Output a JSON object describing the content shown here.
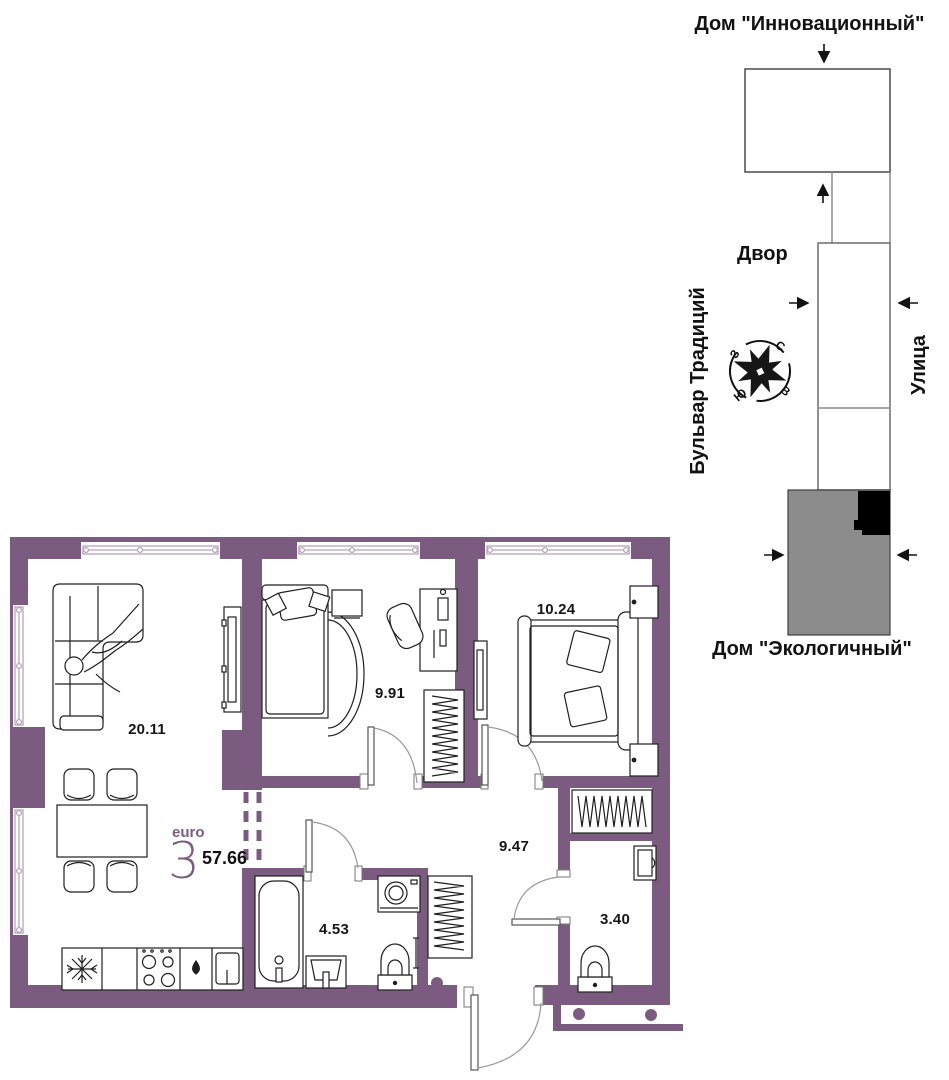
{
  "minimap": {
    "building_top_label": "Дом \"Инновационный\"",
    "building_bottom_label": "Дом \"Экологичный\"",
    "yard_label": "Двор",
    "boulevard_label": "Бульвар Традиций",
    "street_label": "Улица",
    "compass": {
      "north": "С",
      "east": "В",
      "south": "Ю",
      "west": "З"
    }
  },
  "plan": {
    "layout_label": "euro",
    "rooms_count": "3",
    "total_area": "57.66",
    "rooms": [
      {
        "name": "living-kitchen",
        "area": "20.11"
      },
      {
        "name": "bedroom-1",
        "area": "9.91"
      },
      {
        "name": "bedroom-2",
        "area": "10.24"
      },
      {
        "name": "hallway",
        "area": "9.47"
      },
      {
        "name": "bathroom",
        "area": "4.53"
      },
      {
        "name": "wc",
        "area": "3.40"
      }
    ]
  },
  "colors": {
    "wall": "#7B5C80",
    "accent": "#7d5c84",
    "building_gray": "#8c8c8c",
    "building_highlight": "#000000"
  }
}
